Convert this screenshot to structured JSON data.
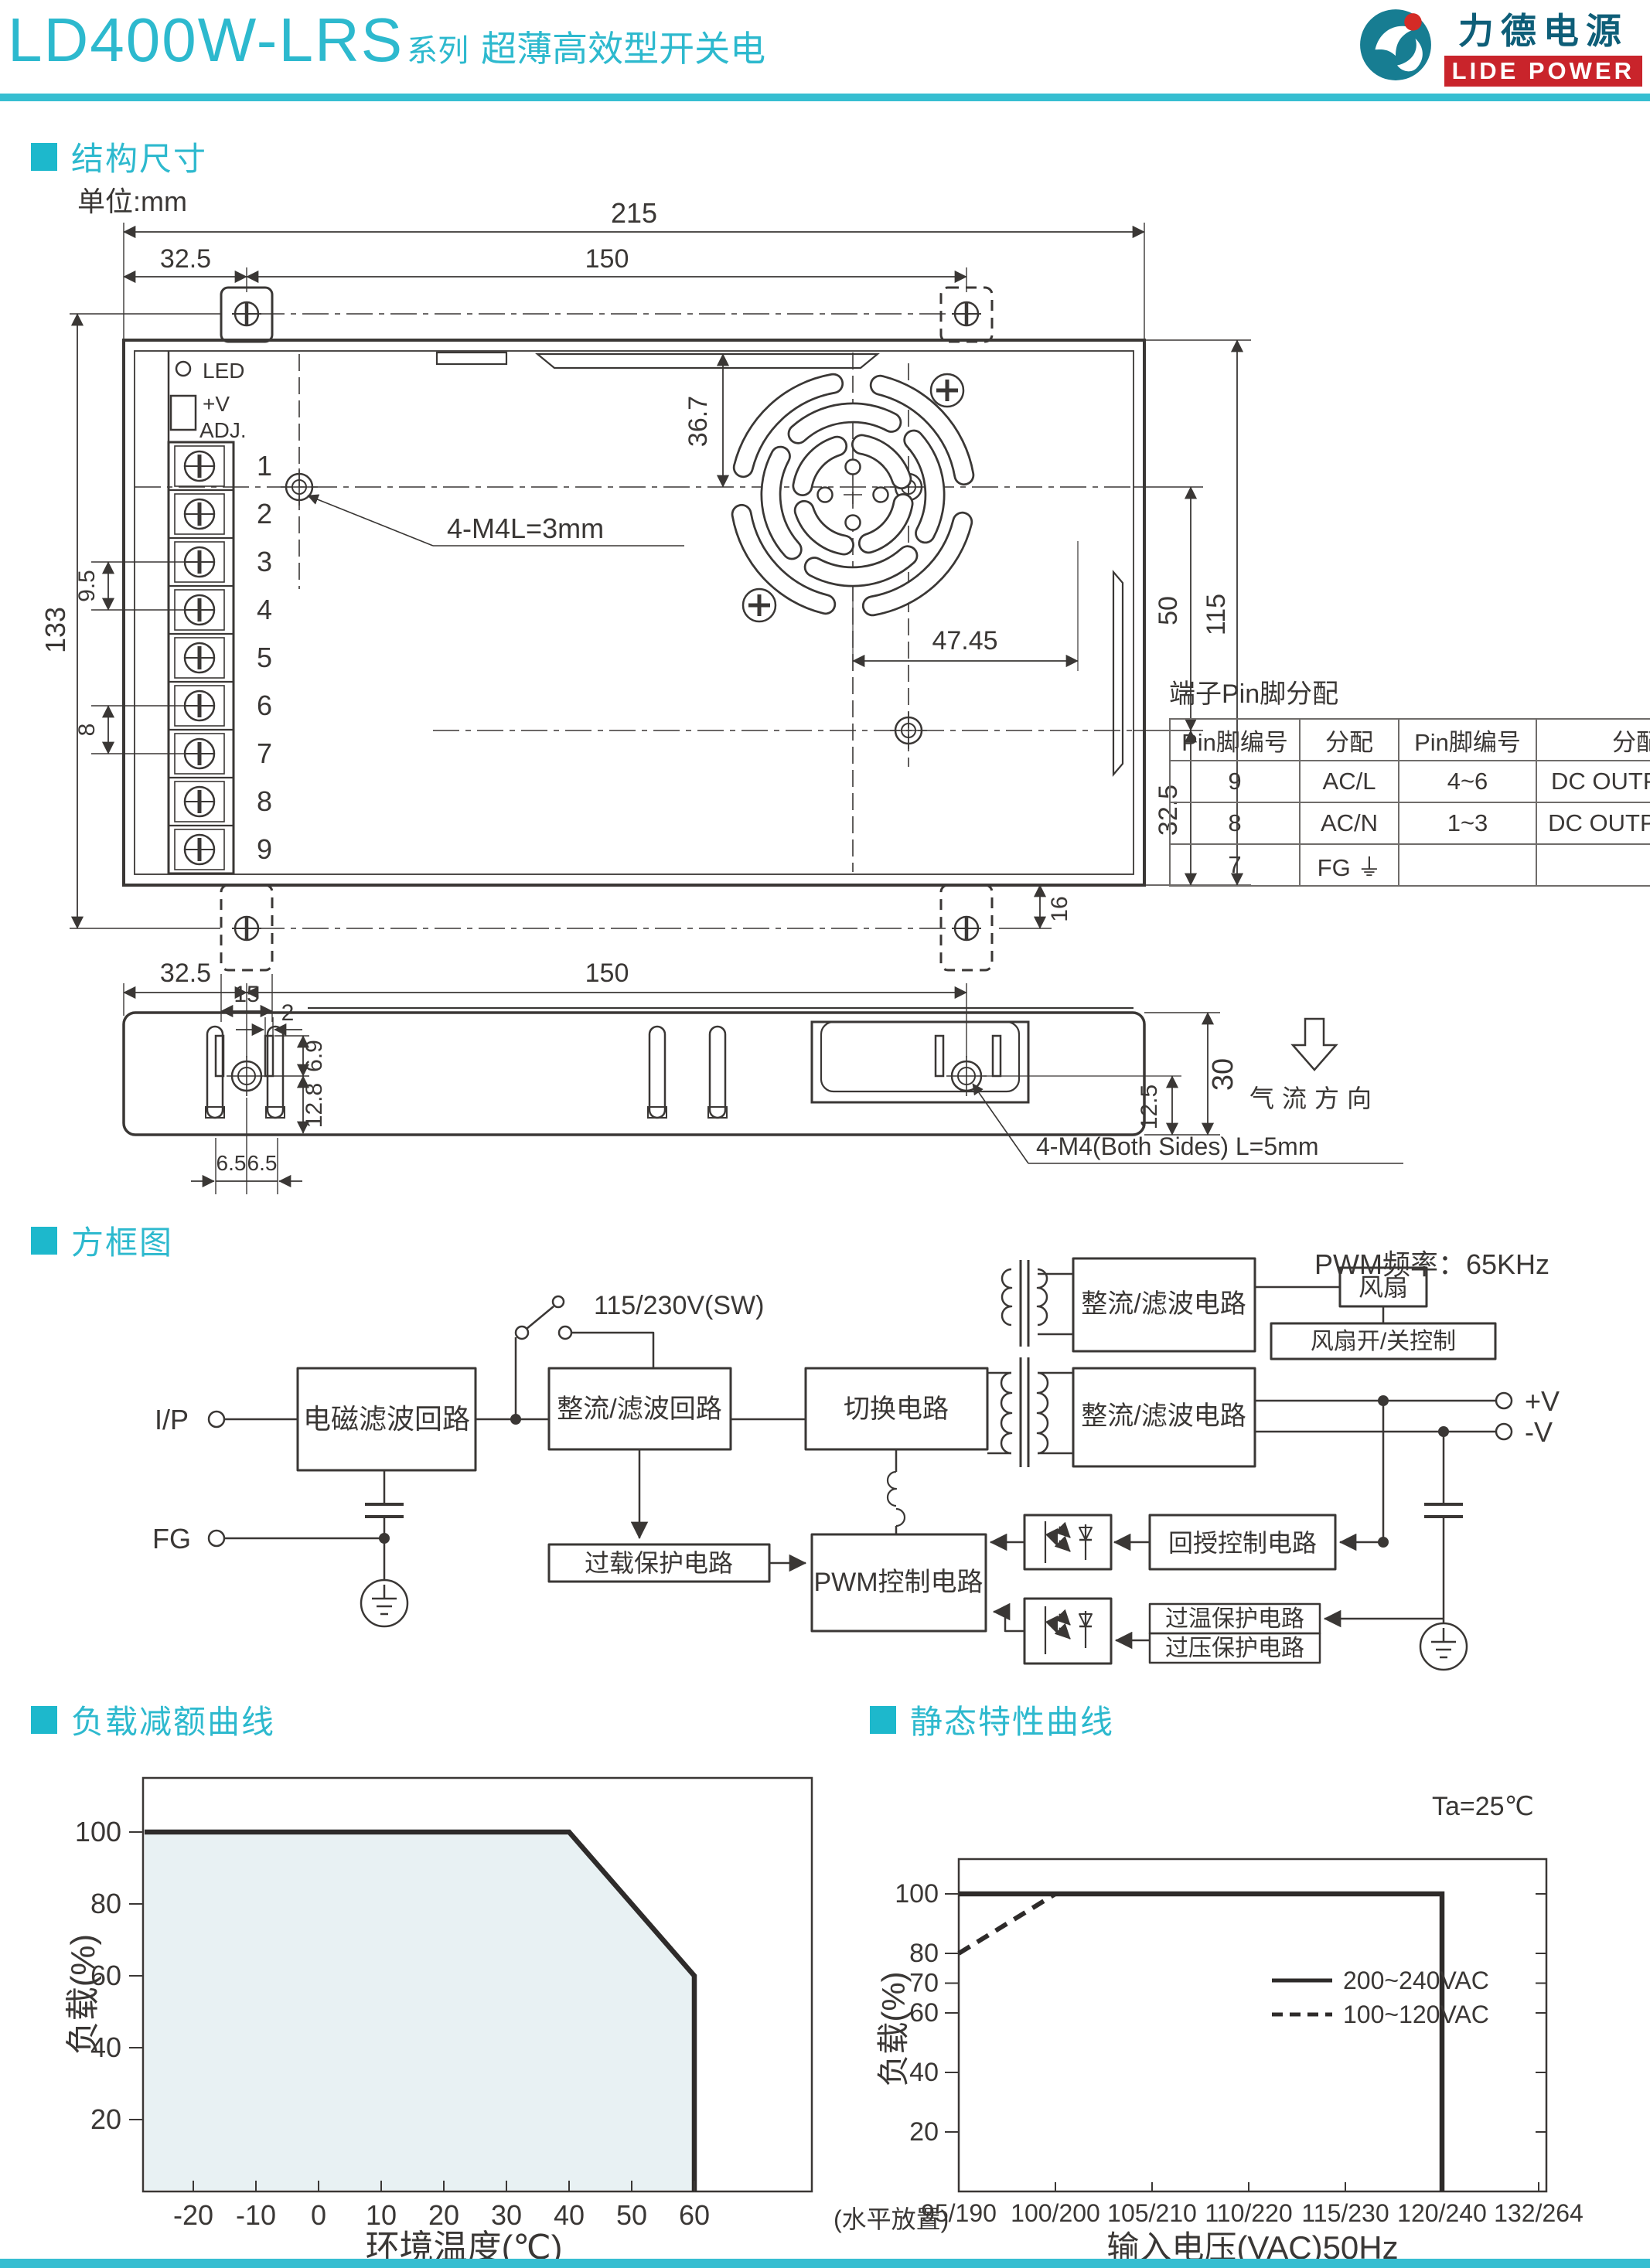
{
  "header": {
    "model": "LD400W-LRS",
    "series": "系列",
    "subtitle": "超薄高效型开关电",
    "logo_cn": "力德电源",
    "logo_en": "LIDE POWER"
  },
  "colors": {
    "accent": "#2db9ce",
    "logo_red": "#c9242b",
    "logo_teal": "#177d92",
    "ink": "#3a3735",
    "chart_fill": "#e8f1f3"
  },
  "sections": {
    "structure": "结构尺寸",
    "block": "方框图",
    "derating": "负载减额曲线",
    "static": "静态特性曲线"
  },
  "structure": {
    "unit": "单位:mm",
    "led": "LED",
    "adj_line1": "+V",
    "adj_line2": "ADJ.",
    "pins": [
      "1",
      "2",
      "3",
      "4",
      "5",
      "6",
      "7",
      "8",
      "9"
    ],
    "screw_note": "4-M4L=3mm",
    "side_screw_note": "4-M4(Both Sides) L=5mm",
    "airflow": "气流方向",
    "dims": {
      "width": "215",
      "offset": "32.5",
      "span": "150",
      "height": "133",
      "pitch": "9.5",
      "pitch2": "8",
      "fan_top": "36.7",
      "hole_span": "50",
      "body_height": "115",
      "fan_offset": "47.45",
      "hole_bottom": "32.5",
      "tab_height": "16",
      "tab_width": "15",
      "side_offset": "32.5",
      "side_span": "150",
      "slot_w": "2",
      "slot_h": "6.9",
      "screw_y": "12.8",
      "s65a": "6.5",
      "s65b": "6.5",
      "side_height": "30",
      "screw_bottom": "12.5"
    },
    "pin_table": {
      "title": "端子Pin脚分配",
      "headers": [
        "Pin脚编号",
        "分配",
        "Pin脚编号",
        "分配"
      ],
      "rows": [
        [
          "9",
          "AC/L",
          "4~6",
          "DC OUTPUT -V"
        ],
        [
          "8",
          "AC/N",
          "1~3",
          "DC OUTPUT +V"
        ],
        [
          "7",
          "FG ⏚",
          "",
          ""
        ]
      ]
    }
  },
  "block": {
    "pwm_freq": "PWM频率：65KHz",
    "ip": "I/P",
    "fg": "FG",
    "switch_label": "115/230V(SW)",
    "vplus": "+V",
    "vminus": "-V",
    "boxes": {
      "emi": "电磁滤波回路",
      "rectifier_in": "整流/滤波回路",
      "switching": "切换电路",
      "rectifier_out": "整流/滤波电路",
      "rectifier_fan": "整流/滤波电路",
      "fan": "风扇",
      "fan_ctrl": "风扇开/关控制",
      "overload": "过载保护电路",
      "pwm": "PWM控制电路",
      "feedback": "回授控制电路",
      "otp": "过温保护电路",
      "ovp": "过压保护电路"
    }
  },
  "chart_data": [
    {
      "type": "area",
      "title": "负载减额曲线",
      "xlabel": "环境温度(℃)",
      "ylabel": "负载(%)",
      "x_note": "(水平放置)",
      "x_ticks": [
        -20,
        -10,
        0,
        10,
        20,
        30,
        40,
        50,
        60
      ],
      "y_ticks": [
        20,
        40,
        60,
        80,
        100
      ],
      "xlim": [
        -28,
        70
      ],
      "ylim": [
        0,
        115
      ],
      "points": [
        [
          -28,
          100
        ],
        [
          40,
          100
        ],
        [
          60,
          60
        ],
        [
          60,
          0
        ]
      ],
      "grid": false,
      "fill": "#e8f1f3",
      "line_color": "#2e2b2a"
    },
    {
      "type": "line",
      "title": "静态特性曲线",
      "note": "Ta=25℃",
      "xlabel": "输入电压(VAC)50Hz",
      "ylabel": "负载(%)",
      "x_tick_labels": [
        "95/190",
        "100/200",
        "105/210",
        "110/220",
        "115/230",
        "120/240",
        "132/264"
      ],
      "y_ticks": [
        20,
        40,
        60,
        70,
        80,
        100
      ],
      "ylim": [
        0,
        112
      ],
      "grid": false,
      "legend_position": "upper-right-inside",
      "series": [
        {
          "name": "200~240VAC",
          "style": "solid",
          "points_idx": [
            [
              0,
              100
            ],
            [
              5,
              100
            ],
            [
              5,
              0
            ]
          ]
        },
        {
          "name": "100~120VAC",
          "style": "dashed",
          "points_idx": [
            [
              0,
              80
            ],
            [
              1,
              100
            ]
          ]
        }
      ]
    }
  ]
}
